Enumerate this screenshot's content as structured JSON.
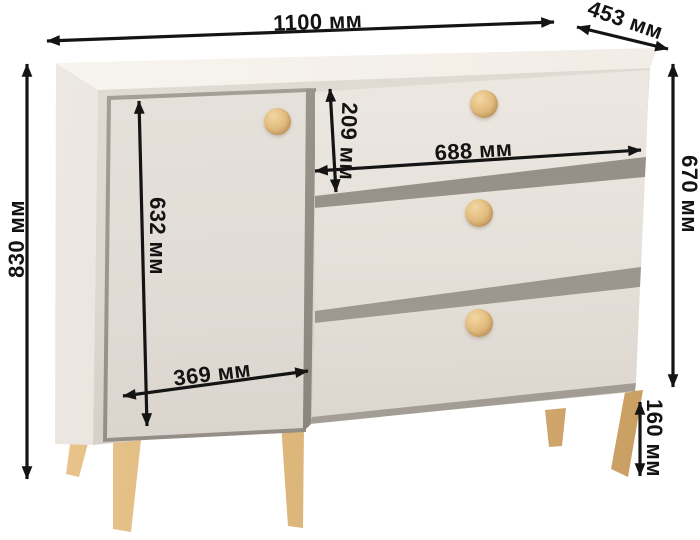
{
  "diagram": {
    "unit": "мм",
    "labels": {
      "width": "1100 мм",
      "depth": "453 мм",
      "total_height": "830 мм",
      "body_height": "670 мм",
      "door_height": "632 мм",
      "door_width": "369 мм",
      "drawer_front_height": "209 мм",
      "drawer_width": "688 мм",
      "leg_height": "160 мм"
    }
  },
  "furniture": {
    "doors": 1,
    "drawers": 3,
    "knobs": 4,
    "legs_visible": 5
  },
  "colors": {
    "background": "#ffffff",
    "cabinet_top": "#f5f1ea",
    "cabinet_side": "#e9e4de",
    "cabinet_front": "#ddd7d0",
    "drawer_face": "#e6e1da",
    "slat_gap_shadow": "#8d8780",
    "knob_wood": "#dfb87c",
    "leg_wood": "#ddb37b",
    "dimension_lines": "#141414"
  }
}
